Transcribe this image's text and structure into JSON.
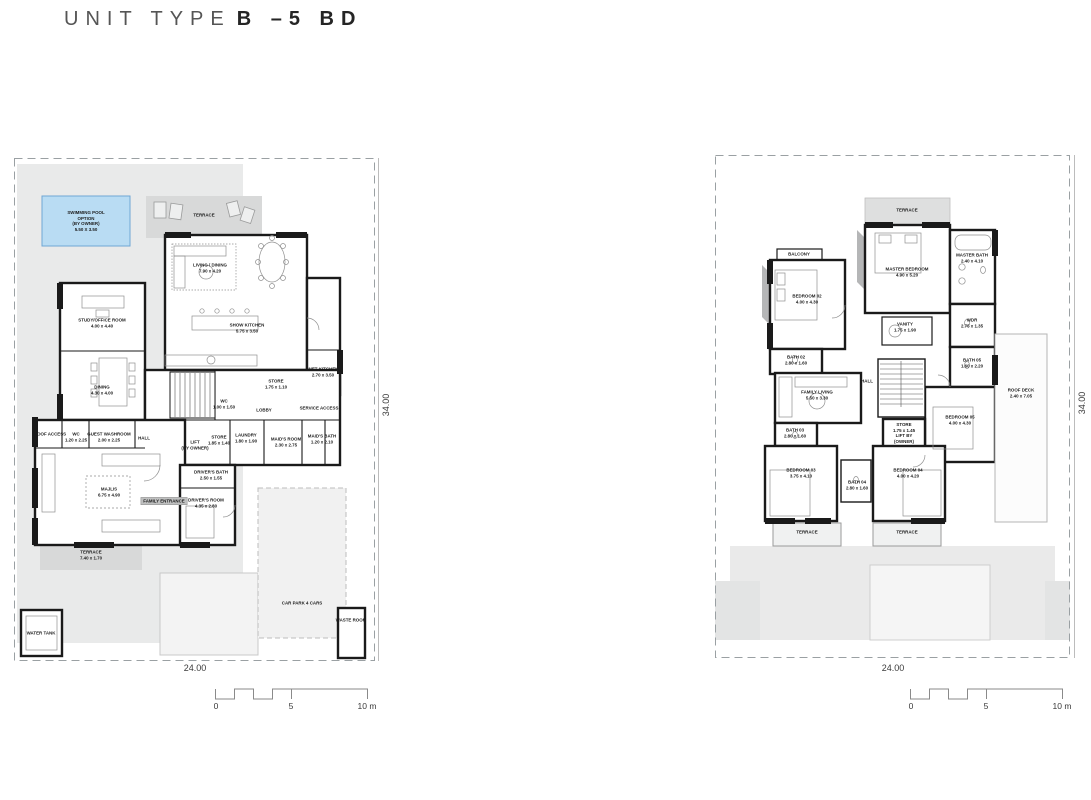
{
  "title": {
    "light": "UNIT TYPE",
    "bold": "B –5 BD"
  },
  "colors": {
    "pool_fill": "#b9dcf3",
    "pool_border": "#6fa7d4",
    "site_grey": "#e9eaea",
    "terrace_grey": "#d8d9d9",
    "wall_black": "#1a1a1a",
    "plot_dash": "#9aa0a3"
  },
  "plans": [
    {
      "name": "ground-floor-plan",
      "width_dim": "24.00",
      "height_dim": "34.00",
      "scale_bar": {
        "t0": "0",
        "t5": "5",
        "t10": "10 m"
      },
      "labels": [
        {
          "n": "pool-label",
          "t": "SWIMMING POOL\nOPTION\n(BY OWNER)\n5.50 X 3.50",
          "x": 72,
          "y": 63
        },
        {
          "n": "terrace-top-label",
          "t": "TERRACE",
          "x": 190,
          "y": 57
        },
        {
          "n": "living-dining-label",
          "t": "LIVING / DINING\n7.90 x 4.20",
          "x": 196,
          "y": 110
        },
        {
          "n": "show-kitchen-label",
          "t": "SHOW KITCHEN\n5.75 x 3.50",
          "x": 233,
          "y": 170
        },
        {
          "n": "study-office-label",
          "t": "STUDY/OFFICE ROOM\n4.00 x 4.40",
          "x": 88,
          "y": 165
        },
        {
          "n": "dining-label",
          "t": "DINING\n4.30 x 4.00",
          "x": 88,
          "y": 232
        },
        {
          "n": "wet-kitchen-label",
          "t": "WET KITCHEN\n2.70 x 3.50",
          "x": 309,
          "y": 214
        },
        {
          "n": "store-pantry-label",
          "t": "STORE\n1.75 x 1.10",
          "x": 262,
          "y": 226
        },
        {
          "n": "wc-stair-label",
          "t": "WC\n1.00 x 1.50",
          "x": 210,
          "y": 246
        },
        {
          "n": "lobby-label",
          "t": "LOBBY",
          "x": 250,
          "y": 252
        },
        {
          "n": "store-label",
          "t": "STORE\n1.85 x 1.40",
          "x": 205,
          "y": 282
        },
        {
          "n": "laundry-label",
          "t": "LAUNDRY\n1.80 x 1.90",
          "x": 232,
          "y": 280
        },
        {
          "n": "maids-room-label",
          "t": "MAID'S ROOM\n2.30 x 2.75",
          "x": 272,
          "y": 284
        },
        {
          "n": "maids-bath-label",
          "t": "MAID'S BATH\n1.20 x 2.10",
          "x": 308,
          "y": 281
        },
        {
          "n": "service-access-label",
          "t": "SERVICE ACCESS",
          "x": 305,
          "y": 250
        },
        {
          "n": "lift-label",
          "t": "LIFT\n(BY OWNER)",
          "x": 181,
          "y": 287
        },
        {
          "n": "roof-access-label",
          "t": "ROOF ACCESS",
          "x": 36,
          "y": 276
        },
        {
          "n": "wc-guest-label",
          "t": "WC\n1.20 x 2.25",
          "x": 62,
          "y": 279
        },
        {
          "n": "guest-washroom-label",
          "t": "GUEST WASHROOM\n2.00 x 2.25",
          "x": 95,
          "y": 279
        },
        {
          "n": "hall-label",
          "t": "HALL",
          "x": 130,
          "y": 280
        },
        {
          "n": "majlis-label",
          "t": "MAJLIS\n6.75 x 4.90",
          "x": 95,
          "y": 334
        },
        {
          "n": "family-entrance-label",
          "t": "FAMILY ENTRANCE",
          "x": 150,
          "y": 343,
          "chip": true
        },
        {
          "n": "drivers-bath-label",
          "t": "DRIVER'S BATH\n2.50 x 1.55",
          "x": 197,
          "y": 317
        },
        {
          "n": "drivers-room-label",
          "t": "DRIVER'S ROOM\n4.35 x 2.80",
          "x": 192,
          "y": 345
        },
        {
          "n": "terrace-majlis-label",
          "t": "TERRACE\n7.40 x 1.70",
          "x": 77,
          "y": 397
        },
        {
          "n": "car-park-label",
          "t": "CAR PARK 4 CARS",
          "x": 288,
          "y": 445
        },
        {
          "n": "waste-room-label",
          "t": "WASTE ROOM",
          "x": 337,
          "y": 462
        },
        {
          "n": "water-tank-label",
          "t": "WATER TANK",
          "x": 27,
          "y": 475
        }
      ]
    },
    {
      "name": "first-floor-plan",
      "width_dim": "24.00",
      "height_dim": "34.00",
      "scale_bar": {
        "t0": "0",
        "t5": "5",
        "t10": "10 m"
      },
      "labels": [
        {
          "n": "terrace-master-label",
          "t": "TERRACE",
          "x": 192,
          "y": 55
        },
        {
          "n": "master-bedroom-label",
          "t": "MASTER BEDROOM\n4.90 x 5.20",
          "x": 192,
          "y": 117
        },
        {
          "n": "balcony-label",
          "t": "BALCONY",
          "x": 84,
          "y": 99
        },
        {
          "n": "bedroom-02-label",
          "t": "BEDROOM 02\n4.00 x 4.30",
          "x": 92,
          "y": 144
        },
        {
          "n": "bath-02-label",
          "t": "BATH 02\n2.80 x 1.60",
          "x": 81,
          "y": 205
        },
        {
          "n": "master-bath-label",
          "t": "MASTER BATH\n2.40 x 4.10",
          "x": 257,
          "y": 103
        },
        {
          "n": "wardrobe-label",
          "t": "WDR\n2.75 x 1.35",
          "x": 257,
          "y": 168
        },
        {
          "n": "vanity-label",
          "t": "VANITY\n1.75 x 1.90",
          "x": 190,
          "y": 172
        },
        {
          "n": "family-living-label",
          "t": "FAMILY LIVING\n5.50 x 3.30",
          "x": 102,
          "y": 240
        },
        {
          "n": "hall-label",
          "t": "HALL",
          "x": 152,
          "y": 226
        },
        {
          "n": "store-lift-label",
          "t": "STORE\n1.75 x 1.45\nLIFT BY\n(OWNER)",
          "x": 189,
          "y": 278
        },
        {
          "n": "bath-03-label",
          "t": "BATH 03\n2.80 x 1.60",
          "x": 80,
          "y": 278
        },
        {
          "n": "bedroom-03-label",
          "t": "BEDROOM 03\n3.75 x 4.10",
          "x": 86,
          "y": 318
        },
        {
          "n": "bedroom-04-label",
          "t": "BEDROOM 04\n4.00 x 4.20",
          "x": 193,
          "y": 318
        },
        {
          "n": "bath-04-label",
          "t": "BATH 04\n2.80 x 1.60",
          "x": 142,
          "y": 330
        },
        {
          "n": "bath-05-label",
          "t": "BATH 05\n1.60 x 2.20",
          "x": 257,
          "y": 208
        },
        {
          "n": "bedroom-05-label",
          "t": "BEDROOM 05\n4.00 x 4.30",
          "x": 245,
          "y": 265
        },
        {
          "n": "roof-deck-label",
          "t": "ROOF DECK\n2.40 x 7.05",
          "x": 306,
          "y": 238
        },
        {
          "n": "terrace-left-label",
          "t": "TERRACE",
          "x": 92,
          "y": 377
        },
        {
          "n": "terrace-right-label",
          "t": "TERRACE",
          "x": 192,
          "y": 377
        }
      ]
    }
  ]
}
